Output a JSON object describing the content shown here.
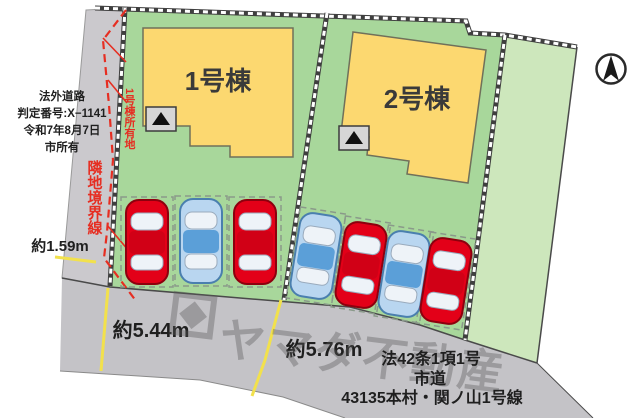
{
  "plan": {
    "title_context": "site-plan",
    "buildings": [
      {
        "label": "1号棟"
      },
      {
        "label": "2号棟"
      }
    ],
    "legal_road_note": {
      "lines": [
        "法外道路",
        "判定番号:X−1141",
        "令和7年8月7日",
        "市所有"
      ]
    },
    "boundary_labels": {
      "neighbor": "隣地境界線",
      "bldg1_owner": "1号棟所有地"
    },
    "dimensions": {
      "left_width": "約1.59m",
      "frontage_left": "約5.44m",
      "frontage_right": "約5.76m"
    },
    "road_info": {
      "lines": [
        "法42条1項1号",
        "市道",
        "43135本村・関ノ山1号線"
      ]
    },
    "watermark": {
      "text": "ヤマダ不動産"
    }
  },
  "cars": [
    {
      "plot": 1,
      "color": "red"
    },
    {
      "plot": 1,
      "color": "blue"
    },
    {
      "plot": 1,
      "color": "red"
    },
    {
      "plot": 2,
      "color": "blue"
    },
    {
      "plot": 2,
      "color": "red"
    },
    {
      "plot": 2,
      "color": "blue"
    },
    {
      "plot": 2,
      "color": "red"
    }
  ],
  "colors": {
    "main_green": "#a8d79b",
    "light_green": "#cde7bc",
    "building_yellow": "#fcd870",
    "road_gray": "#c4c3c7",
    "strip_gray": "#cbc9cd",
    "line_yellow": "#f2e14c",
    "boundary_red": "#e62e22",
    "window": "#eef3f8",
    "red_car": {
      "body": "#e30018",
      "accent": "#d10016",
      "edge": "#8d000e"
    },
    "blue_car": {
      "body": "#b9d6f0",
      "accent": "#5b9fd8",
      "edge": "#4a7fae"
    }
  }
}
